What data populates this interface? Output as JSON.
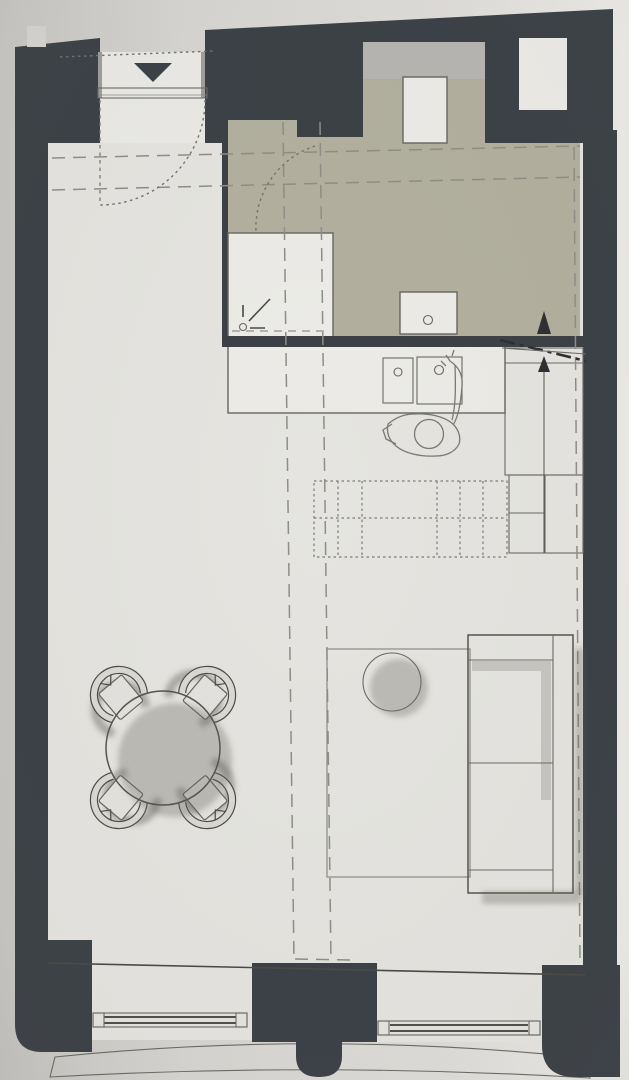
{
  "meta": {
    "description": "Photographed architectural floor plan of a studio apartment, top-down view, no text labels visible"
  },
  "colors": {
    "paper_left": "#c6c5c2",
    "paper_mid": "#d8d6d3",
    "paper_right": "#edebe8",
    "floor": "#e5e4e0",
    "floor_light": "#eae9e6",
    "wall": "#3b4046",
    "bath_zone": "#b2af9e",
    "counter_gray": "#b7b5b1",
    "fixture_white": "#ecebe7",
    "cabinet_gray": "#c7c6c2",
    "cabinet_gray2": "#c2c1bd",
    "table": "#e7e6e2",
    "sofa": "#e4e3df",
    "sofa_shade": "#c6c5c1",
    "door_gray": "#bebdb9",
    "glazing": "#d8d7d3",
    "arrow_dark": "#2c2f33",
    "notch_paper": "#d5d3d0",
    "shadow_soft": "rgba(95,95,88,0.32)"
  },
  "objects": {
    "entry": [
      "entrance-opening",
      "entry-direction-triangle",
      "door-slab",
      "door-swing-arc"
    ],
    "bathroom": [
      "shower-tray",
      "shower-drain",
      "wc-fixture",
      "bathroom-door-arc"
    ],
    "kitchen": [
      "kitchen-counter",
      "sink-left",
      "sink-right",
      "person-figure",
      "tall-cabinet",
      "low-cabinet",
      "appliance-box",
      "wall-niche"
    ],
    "living": [
      "dining-table",
      "dining-chairs",
      "rug-outline",
      "side-pouf",
      "sofa",
      "shelving-grid"
    ],
    "windows": [
      "window-left",
      "window-right",
      "window-sill-band"
    ],
    "annotations": [
      "section-cut-line",
      "section-arrow-up",
      "mezzanine-dashed-lines"
    ]
  }
}
